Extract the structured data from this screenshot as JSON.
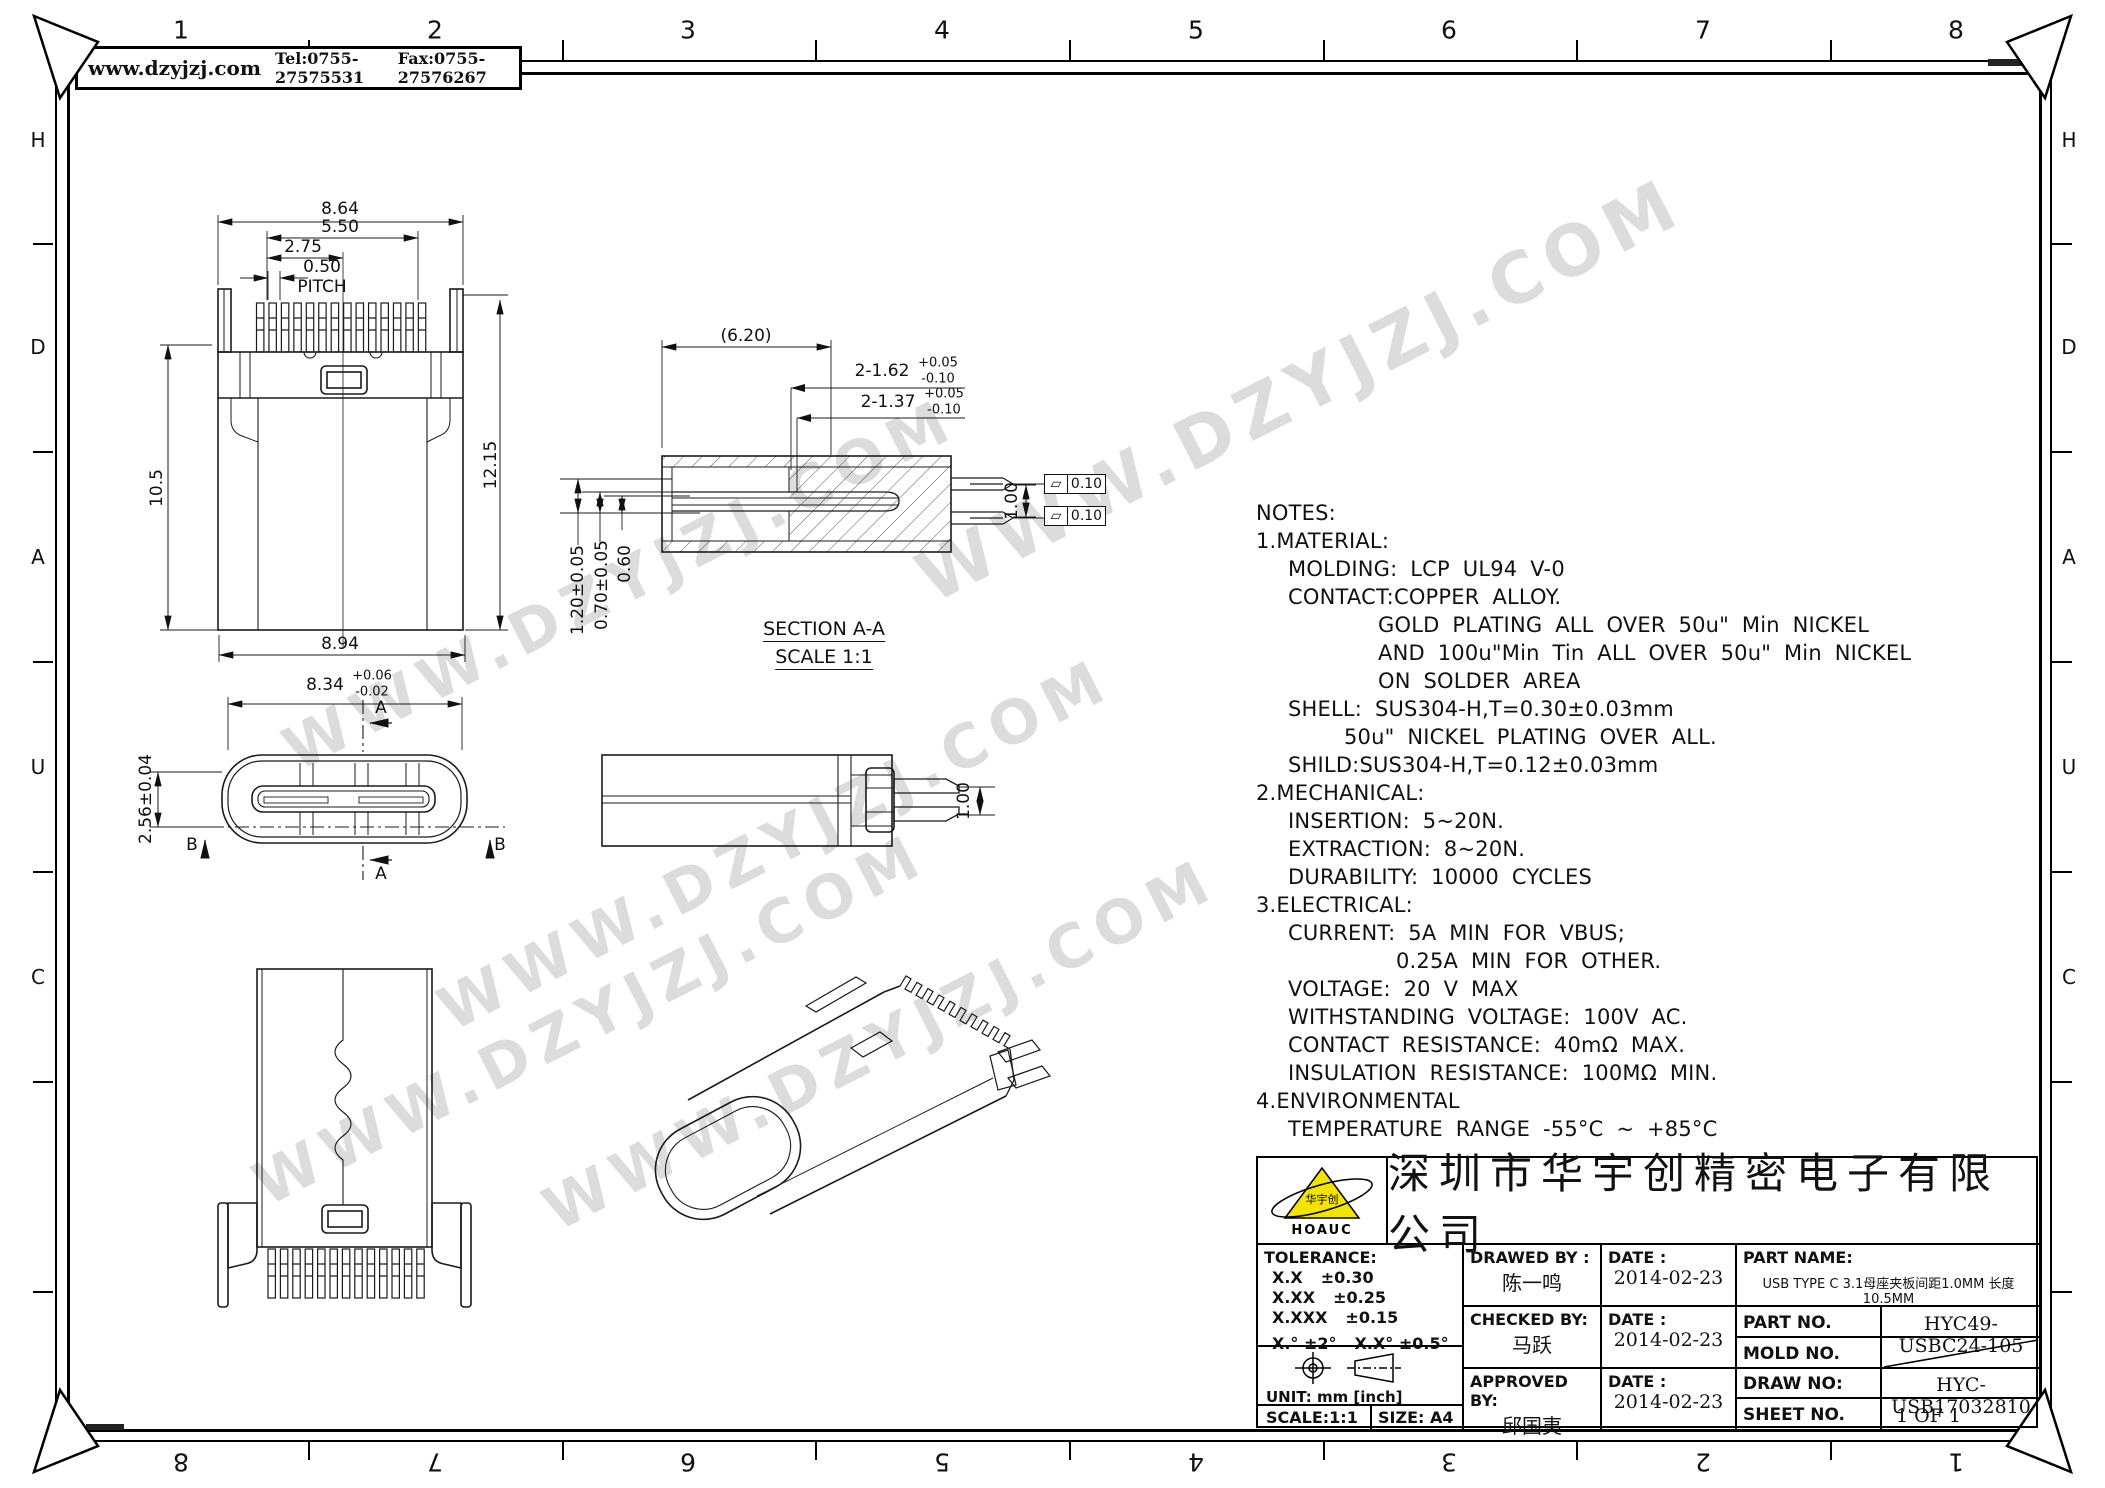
{
  "header": {
    "website": "www.dzyjzj.com",
    "tel": "Tel:0755-27575531",
    "fax": "Fax:0755-27576267"
  },
  "watermark": {
    "text": "WWW.DZYJZJ.COM"
  },
  "ruler": {
    "cols": [
      "1",
      "2",
      "3",
      "4",
      "5",
      "6",
      "7",
      "8"
    ],
    "rows": [
      "H",
      "D",
      "A",
      "U",
      "C"
    ]
  },
  "views": {
    "top": {
      "d1": "8.64",
      "d2": "5.50",
      "d3": "2.75",
      "d4": "0.50",
      "pitch": "PITCH",
      "left": "10.5",
      "right": "12.15",
      "bottom": "8.94"
    },
    "front": {
      "w": "8.34",
      "w_up": "+0.06",
      "w_dn": "-0.02",
      "h": "2.56±0.04",
      "a": "A",
      "b": "B"
    },
    "section": {
      "title": "SECTION A-A",
      "scale": "SCALE 1:1",
      "len": "(6.20)",
      "p1": "2-1.62",
      "p1_up": "+0.05",
      "p1_dn": "-0.10",
      "p2": "2-1.37",
      "p2_up": "+0.05",
      "p2_dn": "-0.10",
      "t1": "1.20±0.05",
      "t2": "0.70±0.05",
      "t3": "0.60",
      "gap": "1.00",
      "flat": "0.10",
      "flat_sym": "▱"
    },
    "side": {
      "gap": "1.00"
    }
  },
  "notes": {
    "lines": [
      "NOTES:",
      "1.MATERIAL:",
      "MOLDING: LCP UL94 V-0",
      "CONTACT:COPPER ALLOY.",
      "GOLD PLATING ALL OVER 50u\" Min NICKEL",
      "AND 100u\"Min Tin ALL OVER 50u\" Min NICKEL",
      "ON SOLDER AREA",
      "SHELL: SUS304-H,T=0.30±0.03mm",
      "50u\" NICKEL PLATING OVER ALL.",
      "SHILD:SUS304-H,T=0.12±0.03mm",
      "2.MECHANICAL:",
      "INSERTION: 5~20N.",
      "EXTRACTION: 8~20N.",
      "DURABILITY: 10000 CYCLES",
      "3.ELECTRICAL:",
      "CURRENT: 5A MIN FOR VBUS;",
      "0.25A MIN FOR OTHER.",
      "VOLTAGE: 20 V MAX",
      "WITHSTANDING VOLTAGE: 100V AC.",
      "CONTACT RESISTANCE: 40mΩ MAX.",
      "INSULATION RESISTANCE: 100MΩ MIN.",
      "4.ENVIRONMENTAL",
      "TEMPERATURE RANGE -55°C ~ +85°C"
    ]
  },
  "tb": {
    "company": "深圳市华宇创精密电子有限公司",
    "logo_caption": "HOAUC",
    "logo_cn": "华宇创",
    "tol_title": "TOLERANCE:",
    "tol1l": "X.X",
    "tol1v": "±0.30",
    "tol2l": "X.XX",
    "tol2v": "±0.25",
    "tol3l": "X.XXX",
    "tol3v": "±0.15",
    "tol4": "X.°  ±2°",
    "tol5": "X.X°  ±0.5°",
    "unit": "UNIT:  mm  [inch]",
    "scale": "SCALE:1:1",
    "size": "SIZE:  A4",
    "drawed_label": "DRAWED BY :",
    "drawed_name": "陈一鸣",
    "checked_label": "CHECKED BY:",
    "checked_name": "马跃",
    "approved_label": "APPROVED BY:",
    "approved_name": "邱国夷",
    "date_label": "DATE :",
    "date1": "2014-02-23",
    "date2": "2014-02-23",
    "date3": "2014-02-23",
    "part_name_label": "PART NAME:",
    "part_name": "USB TYPE C 3.1母座夹板间距1.0MM 长度10.5MM",
    "part_no_label": "PART NO.",
    "part_no": "HYC49-USBC24-105",
    "mold_no_label": "MOLD NO.",
    "draw_no_label": "DRAW NO:",
    "draw_no": "HYC-USB17032810",
    "sheet_no_label": "SHEET NO.",
    "sheet_no": "1 OF 1"
  }
}
